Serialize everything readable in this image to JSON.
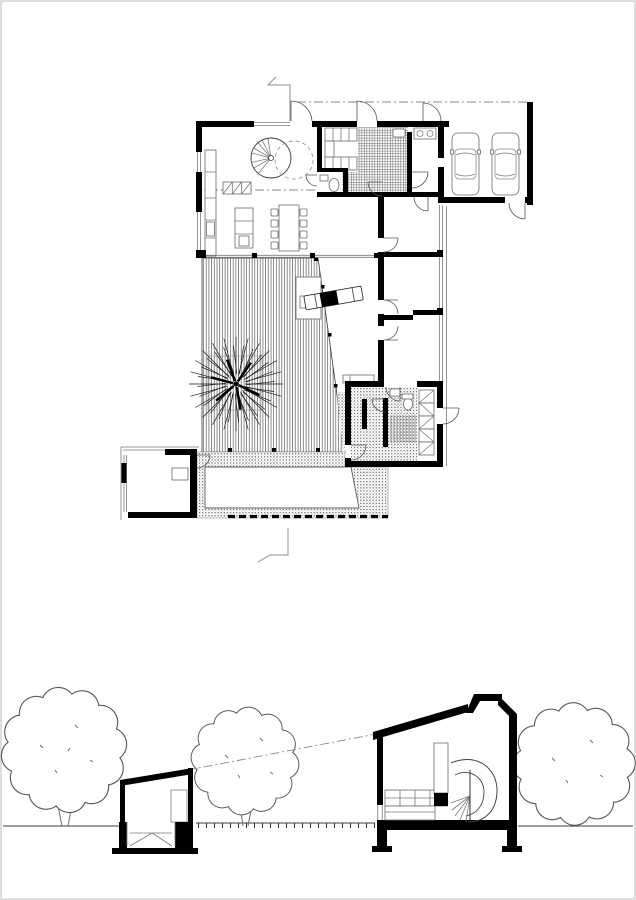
{
  "document": {
    "kind": "architectural drawing sheet",
    "views": {
      "floor_plan": {
        "label": "ground floor plan",
        "elements": [
          "entry-hall",
          "spiral-staircase",
          "wardrobe",
          "kitchen",
          "wc",
          "pantry",
          "carport",
          "living-room",
          "sofa",
          "dining-table",
          "wood-deck",
          "courtyard-tree",
          "chaise-lounge",
          "bedroom-wing",
          "glass-facade",
          "bathroom-sauna",
          "closets",
          "pool-terrace",
          "pool",
          "pool-house",
          "section-cut-markers",
          "roof-overhang-line"
        ]
      },
      "section": {
        "label": "site section",
        "elements": [
          "ground-line",
          "sight-line",
          "pool-house-section",
          "pool-basin",
          "deck-boards",
          "main-house-section",
          "sloped-roof",
          "skylight",
          "spiral-stair-section",
          "kitchen-cabinets-section",
          "foundation-footings",
          "trees"
        ]
      }
    },
    "counts": {
      "cars": 2,
      "plan_trees": 1,
      "section_trees": 3,
      "pools": 1
    },
    "colors": {
      "ink": "#000000",
      "line": "#555555",
      "light": "#999999",
      "background": "#ffffff"
    }
  }
}
